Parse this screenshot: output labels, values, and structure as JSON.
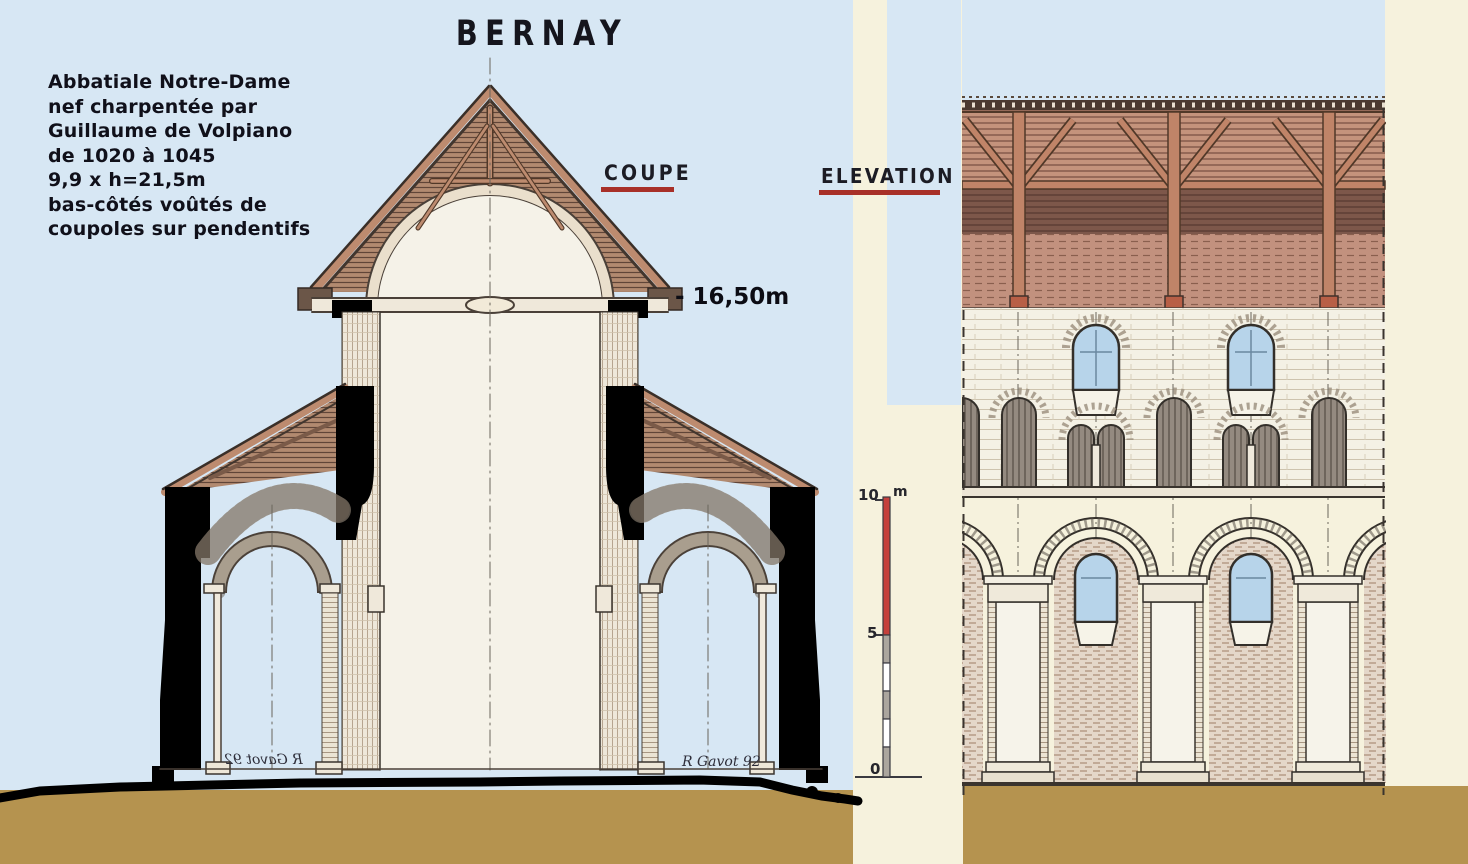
{
  "title": "BERNAY",
  "info_block": {
    "lines": [
      "Abbatiale Notre-Dame",
      "nef charpentée par",
      "Guillaume de Volpiano",
      "de 1020 à 1045",
      "9,9 x h=21,5m",
      "bas-côtés voûtés de",
      "coupoles sur pendentifs"
    ]
  },
  "labels": {
    "coupe": "COUPE",
    "elevation": "ELEVATION",
    "height_annotation": "- 16,50m"
  },
  "scale_bar": {
    "top": "10",
    "unit": "m",
    "middle": "5",
    "bottom": "0"
  },
  "signatures": {
    "left_mirrored": "R Gavot 92",
    "right": "R Gavot 92"
  },
  "colors": {
    "sky": "#d7e7f4",
    "paper": "#f6f2dd",
    "ground": "#b5934f",
    "accent_red": "#a83028",
    "timber": "#bd8b6f",
    "window_blue": "#b7d4ea",
    "ink": "#15151d"
  }
}
